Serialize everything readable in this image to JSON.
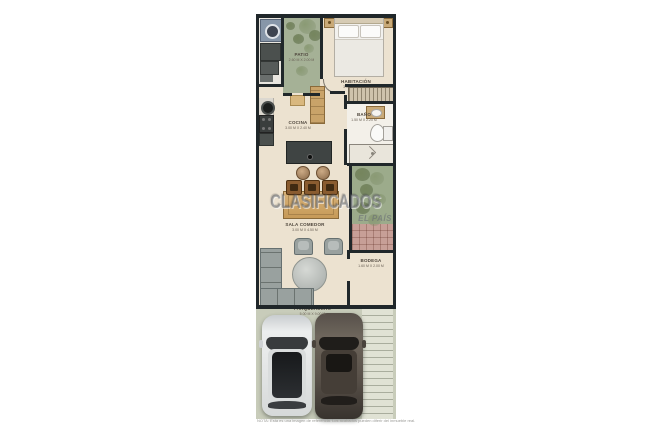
{
  "image": {
    "type": "floor-plan",
    "background": "#ffffff"
  },
  "watermark": {
    "title": "CLASIFICADOS",
    "subtitle": "EL PAÍS"
  },
  "rooms": {
    "patio": {
      "name": "PATIO",
      "dims": "2.60 M X 2.00 M"
    },
    "habitacion": {
      "name": "HABITACIÓN",
      "dims": "3.00 M X 3.20 M"
    },
    "cocina": {
      "name": "COCINA",
      "dims": "3.00 M X 2.40 M"
    },
    "bano": {
      "name": "BAÑO",
      "dims": "1.50 M X 2.20 M"
    },
    "sala": {
      "name": "SALA COMEDOR",
      "dims": "3.00 M X 4.50 M"
    },
    "bodega": {
      "name": "BODEGA",
      "dims": "1.60 M X 2.00 M"
    },
    "parqueadero": {
      "name": "PARQUEADERO",
      "dims": "5.00 M X 9.00 M"
    }
  },
  "footer": {
    "note": "NOTA: Esta es una imagen de referencia. Los acabados pueden diferir del inmueble real."
  },
  "colors": {
    "wall": "#20272a",
    "floor": "#ece2d0",
    "patio_green": "#a5b196",
    "tile": "#c79f97",
    "garage_floor": "#c8ccba",
    "wood": "#c9a369",
    "sofa_gray": "#99a19f",
    "island_dark": "#3f4443"
  }
}
